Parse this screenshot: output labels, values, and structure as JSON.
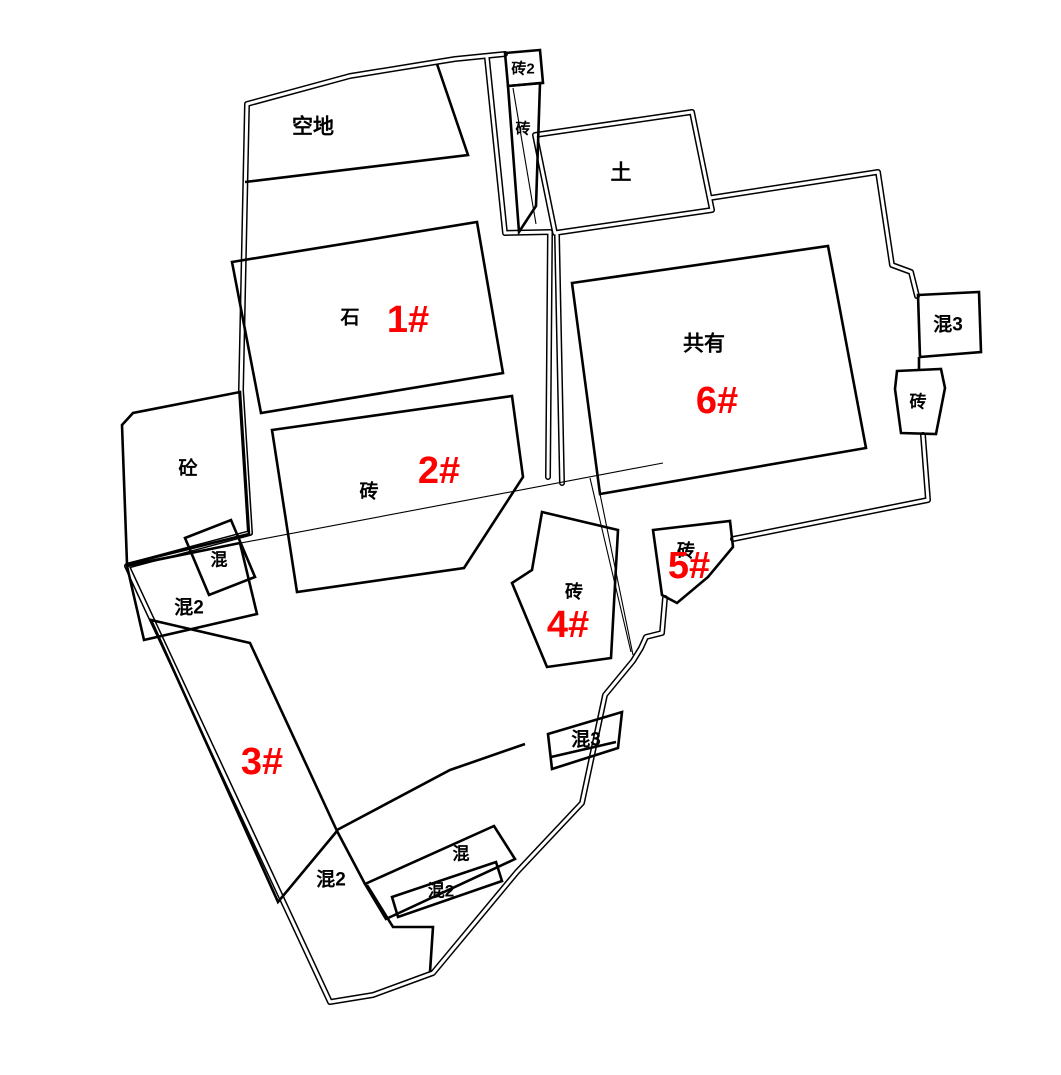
{
  "map_type": "cadastral-parcel-survey-drawing",
  "colors": {
    "line": "#000000",
    "number_red": "#ff0000",
    "background": "#ffffff"
  },
  "labels": {
    "vacant": "空地",
    "brick2": "砖2",
    "brick_strip": "砖",
    "earth": "土",
    "stone": "石",
    "shared": "共有",
    "concrete": "砼",
    "mixed_small": "混",
    "mixed2_left": "混2",
    "brick_bldg2": "砖",
    "mixed3_right": "混3",
    "brick_right": "砖",
    "brick_bldg4": "砖",
    "brick_bldg5": "砖",
    "mixed3_bottom": "混3",
    "mixed2_region": "混2",
    "mixed_cluster": "混",
    "mixed2_cluster": "混2"
  },
  "numbers": {
    "b1": "1#",
    "b2": "2#",
    "b3": "3#",
    "b4": "4#",
    "b5": "5#",
    "b6": "6#"
  }
}
